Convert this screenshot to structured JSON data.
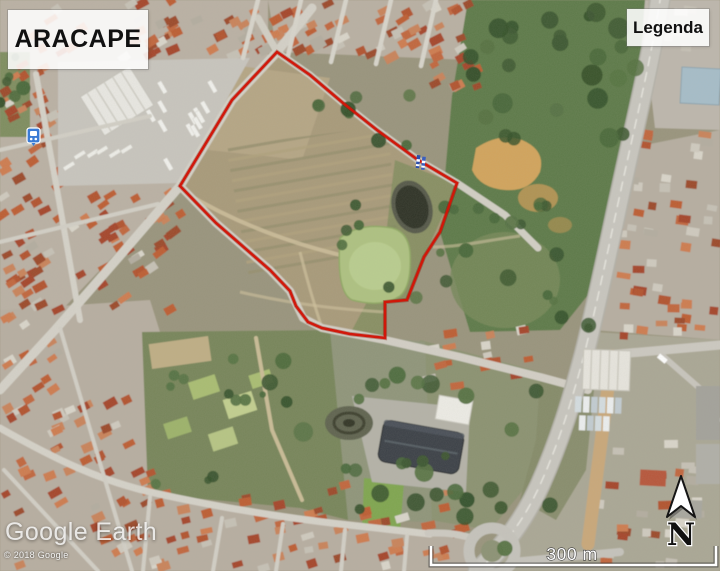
{
  "title_box": {
    "label": "ARACAPE"
  },
  "legend_box": {
    "label": "Legenda"
  },
  "watermark": {
    "brand": "Google Earth",
    "copyright": "© 2018 Google"
  },
  "scale_bar": {
    "label": "300 m"
  },
  "compass": {
    "label": "N"
  },
  "boundary": {
    "color": "#d21507",
    "shadow_color": "#8a1005",
    "points": [
      [
        277,
        52
      ],
      [
        310,
        75
      ],
      [
        343,
        103
      ],
      [
        377,
        130
      ],
      [
        418,
        160
      ],
      [
        457,
        183
      ],
      [
        440,
        232
      ],
      [
        424,
        257
      ],
      [
        407,
        300
      ],
      [
        385,
        302
      ],
      [
        385,
        338
      ],
      [
        350,
        334
      ],
      [
        322,
        328
      ],
      [
        308,
        322
      ],
      [
        296,
        306
      ],
      [
        290,
        291
      ],
      [
        270,
        270
      ],
      [
        216,
        223
      ],
      [
        180,
        186
      ],
      [
        232,
        100
      ]
    ]
  },
  "markers": {
    "bus_stop": {
      "x": 27,
      "y": 128
    },
    "survey_flag": {
      "x": 417,
      "y": 155
    }
  },
  "colors": {
    "label_background": "rgba(255,255,255,0.87)",
    "watermark_text": "rgba(255,255,255,0.8)"
  }
}
